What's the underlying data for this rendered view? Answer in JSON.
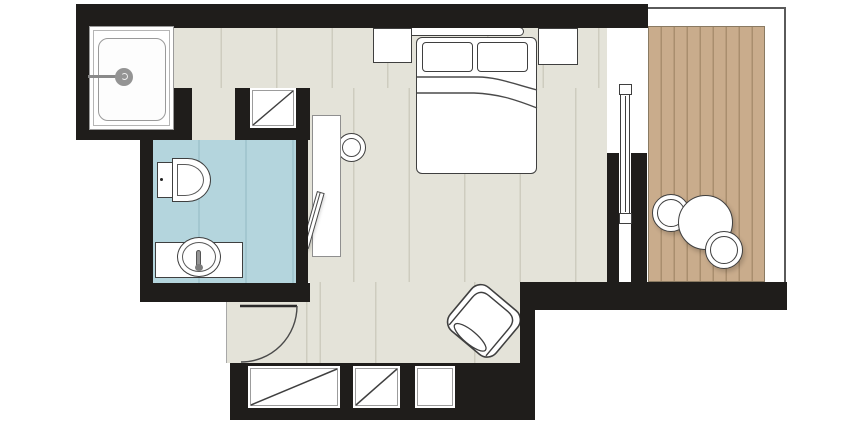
{
  "title": "hotel-room-floor-plan",
  "palette": {
    "wall": "#1f1d1b",
    "bedroom_floor": "#e4e3d9",
    "bathroom_floor": "#b4d5dd",
    "deck": "#c9ac8c",
    "deck_line": "#a98e6e",
    "outline": "#3f3f3f",
    "fixture_grey": "#949494",
    "railing": "#5a5a5a"
  },
  "rooms": {
    "bedroom": {
      "name": "bedroom",
      "floor": "striped light plank",
      "furniture": [
        "headboard",
        "double-bed",
        "pillow-left",
        "pillow-right",
        "nightstand-left",
        "nightstand-right",
        "desk",
        "desk-chair",
        "tv-on-desk",
        "armchair",
        "top-wardrobe",
        "wardrobe-1",
        "wardrobe-2",
        "closet-plain"
      ]
    },
    "bathroom": {
      "name": "bathroom",
      "floor": "blue tile",
      "furniture": [
        "shower-tray",
        "shower-head",
        "toilet",
        "vanity-counter",
        "wash-basin",
        "tap"
      ]
    },
    "balcony": {
      "name": "balcony",
      "floor": "wood deck planks",
      "furniture": [
        "round-table",
        "round-chair-1",
        "round-chair-2"
      ],
      "railing": "thin outline top and right"
    }
  },
  "openings": {
    "entry_door": "hinged door with quarter-circle swing arc, bottom left",
    "bathroom_doorway": "open gap in bathroom top wall",
    "sliding_glass_door": "glass panel symbol between bedroom and balcony"
  }
}
